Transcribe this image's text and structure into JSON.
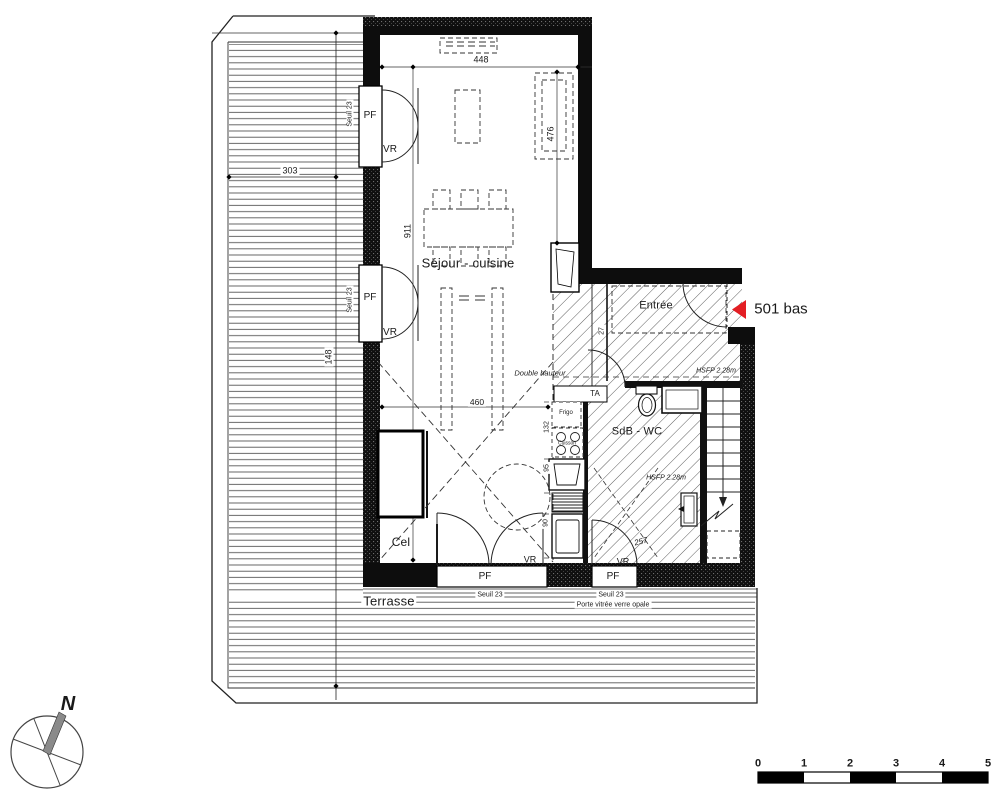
{
  "rooms": {
    "sejour_cuisine": "Séjour - cuisine",
    "entree": "Entrée",
    "sdb_wc": "SdB - WC",
    "cel": "Cel",
    "terrasse": "Terrasse"
  },
  "unit": {
    "label": "501 bas",
    "arrow_color": "#e31e24"
  },
  "annotations": {
    "double_hauteur": "Double hauteur",
    "hsfp_entree": "HSFP 2.28m",
    "hsfp_sdb": "HSFP 2.28m",
    "porte_vitree": "Porte vitrée verre opale",
    "ta": "TA",
    "frigo": "Frigo",
    "cuisson": "Cuisson"
  },
  "openings": {
    "pf": "PF",
    "vr": "VR",
    "seuil": "Seuil 23"
  },
  "dimensions": {
    "top_width": "448",
    "sofa_length": "476",
    "room_height": "911",
    "terrace_width": "303",
    "terrace_left": "148",
    "kitchen_width": "460",
    "kitchen_1": "132",
    "kitchen_2": "95",
    "kitchen_3": "90",
    "sdb_width": "257",
    "entree_dim": "27"
  },
  "compass": {
    "north": "N"
  },
  "scale_bar": {
    "ticks": [
      "0",
      "1",
      "2",
      "3",
      "4",
      "5"
    ]
  }
}
